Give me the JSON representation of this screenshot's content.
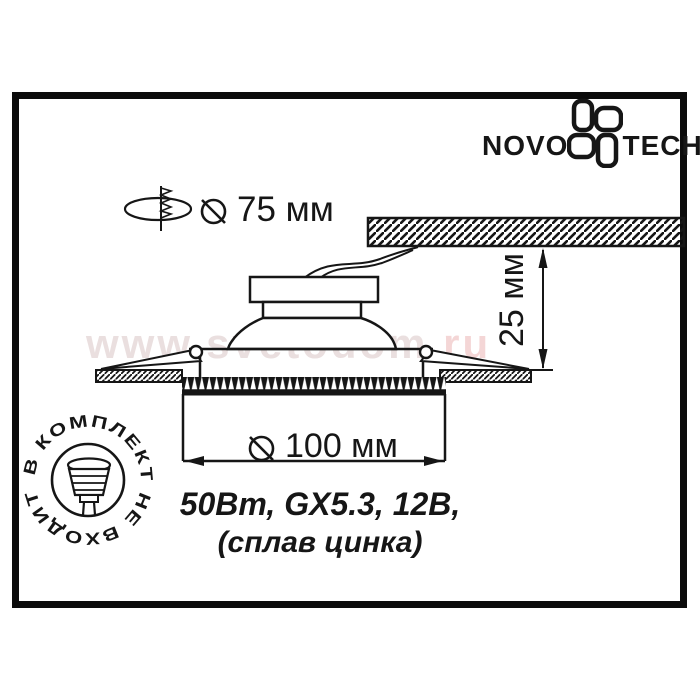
{
  "brand": {
    "text_left": "NOVO",
    "text_right": "TECH",
    "flower_icon": "novotech-flower-icon"
  },
  "cutout_label": {
    "symbol_icon": "diameter-icon",
    "value": "75 мм"
  },
  "diameter_label": {
    "symbol_icon": "diameter-icon",
    "value": "100 мм"
  },
  "height_label": {
    "value": "25 мм"
  },
  "specs": {
    "line1": "50Вт, GX5.3, 12В,",
    "line2": "(сплав цинка)"
  },
  "stamp": {
    "text": "В КОМПЛЕКТ НЕ ВХОДИТ",
    "icon": "mr16-lamp-icon"
  },
  "watermark": {
    "main": "www.svetodom",
    "suffix": ".ru"
  },
  "colors": {
    "ink": "#161616",
    "frame": "#0b0b0b",
    "watermark_main": "#eadfdf",
    "watermark_suffix": "#f4d6d6"
  }
}
